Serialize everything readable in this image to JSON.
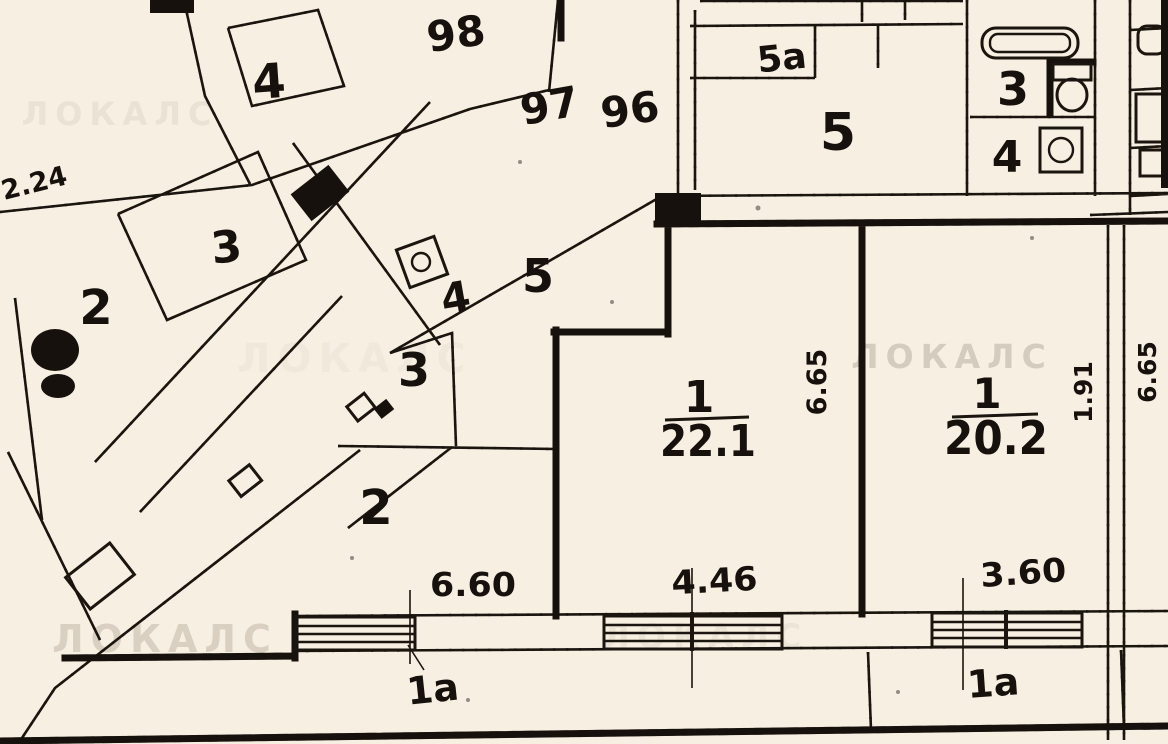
{
  "plan": {
    "watermark": "ЛОКАЛС",
    "site_labels": {
      "building_4": "4",
      "dim_2_24": "2.24",
      "apt_98": "98",
      "apt_97": "97",
      "apt_96": "96",
      "room_3_upper": "3",
      "room_2_small": "2",
      "room_5_mid": "5",
      "room_4_mid": "4",
      "room_3_lower": "3",
      "room_2_large": "2"
    },
    "unit_top_right": {
      "room_5a": "5а",
      "room_5": "5",
      "room_3": "3",
      "room_4": "4"
    },
    "apartments": [
      {
        "room_no": "1",
        "area": "22.1"
      },
      {
        "room_no": "1",
        "area": "20.2"
      }
    ],
    "dimensions": {
      "width_left": "6.60",
      "width_center": "4.46",
      "width_right": "3.60",
      "height_center": "6.65",
      "height_right": "1.91",
      "height_far_right": "6.65"
    },
    "balconies": {
      "left": "1а",
      "right": "1а"
    }
  },
  "colors": {
    "paper": "#f7efe2",
    "ink": "#16110c",
    "watermark": "#cfc6b8"
  }
}
